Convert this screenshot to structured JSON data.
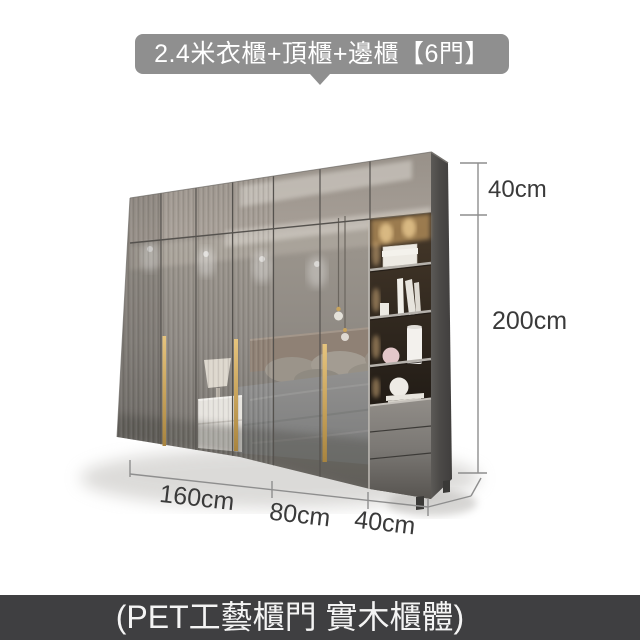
{
  "banner": {
    "title": "2.4米衣櫃+頂櫃+邊櫃【6門】"
  },
  "footer": {
    "caption": "(PET工藝櫃門 實木櫃體)"
  },
  "dimensions": {
    "top_height": "40cm",
    "total_height": "200cm",
    "width_main": "160cm",
    "width_secondary": "80cm",
    "width_side": "40cm"
  },
  "product": {
    "door_count": "6"
  },
  "colors": {
    "banner_bg": "#8f8f8f",
    "footer_bg": "#3f3f41",
    "handle_gold": "#c9a45c",
    "cabinet_side_panel": "#4a4846",
    "dimension_text": "#3a3a3a"
  }
}
